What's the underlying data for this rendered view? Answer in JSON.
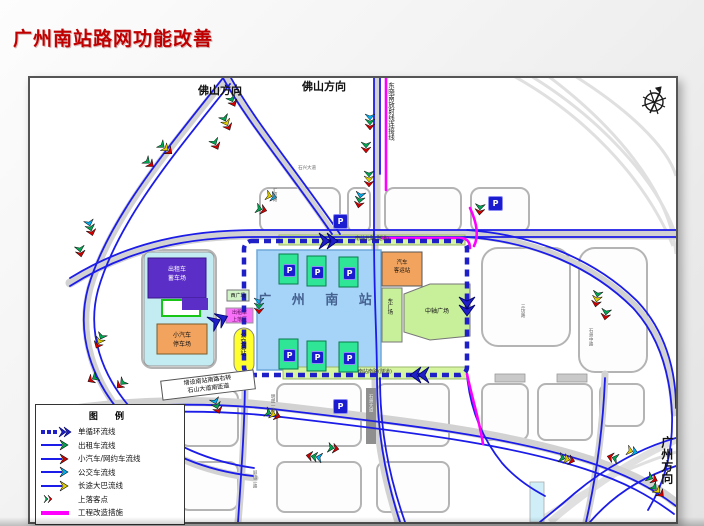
{
  "slide": {
    "title": "广州南站路网功能改善"
  },
  "map": {
    "direction_labels": {
      "foshan_left": "佛山方向",
      "foshan_right": "佛山方向",
      "guangzhou": "广州方向",
      "dongxiaonan_line": "东晓南放射线连接线"
    },
    "station": {
      "name": "广 州 南 站",
      "parking_mark": "P"
    },
    "facilities": {
      "taxi_storage_l1": "出租车",
      "taxi_storage_l2": "蓄车场",
      "car_park_l1": "小汽车",
      "car_park_l2": "停车场",
      "west_square": "西广场",
      "taxi_pickup_l1": "出租车",
      "taxi_pickup_l2": "上落区",
      "bus_terminal": "公交总站",
      "coach_station_l1": "汽车",
      "coach_station_l2": "客运站",
      "east_square": "东广场",
      "central_plaza": "中轴广场"
    },
    "road_labels": {
      "north_road": "南站北路(隧道)",
      "south_road": "南站南路(隧道)",
      "shixing_avenue": "石兴大道",
      "huiying_road": "汇盈路",
      "sanfang_road": "三坊路",
      "shizhou_middle_road": "石洲中路",
      "shizhou_avenue": "石洲大道",
      "mingsheng_road": "明盛一路",
      "pingshan_road": "屏山二路"
    },
    "callout": {
      "line1": "增设南站南路右转",
      "line2": "石山大道南匝道"
    }
  },
  "legend": {
    "title": "图  例",
    "items": [
      {
        "label": "单循环流线",
        "color": "#1f1fc8"
      },
      {
        "label": "出租车流线",
        "color": "#00a651"
      },
      {
        "label": "小汽车/网约车流线",
        "color": "#d00000"
      },
      {
        "label": "公交车流线",
        "color": "#00b0f0"
      },
      {
        "label": "长途大巴流线",
        "color": "#e3d000"
      },
      {
        "label": "上落客点",
        "color": "#d00000"
      },
      {
        "label": "工程改造措施",
        "color": "#ff00ff"
      }
    ]
  },
  "colors": {
    "title_red": "#c00000",
    "flow_blue": "#1c1ce8",
    "loop_navy": "#1f1fc8",
    "measure_magenta": "#ff00ff",
    "station_fill": "#a6d4f8"
  }
}
